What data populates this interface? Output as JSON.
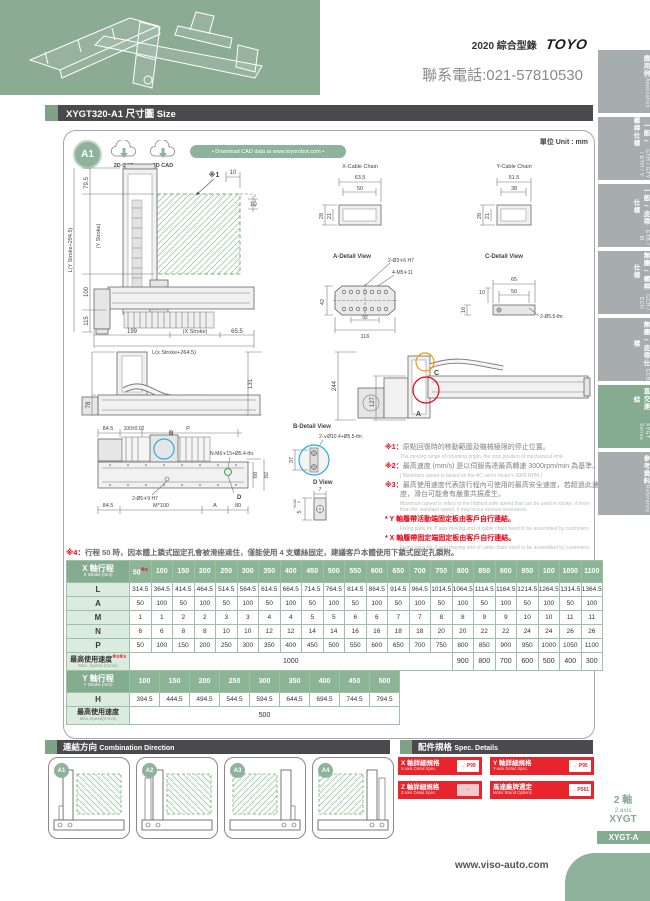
{
  "header": {
    "catalog": "2020 綜合型錄",
    "logo": "TOYO",
    "phone": "聯系電話:021-57810530"
  },
  "title_bar": {
    "text": "XYGT320-A1 尺寸圖 Size"
  },
  "panel": {
    "badge": "A1",
    "cad_2d": "2D CAD",
    "cad_3d": "3D CAD",
    "download": "• Download CAD data at www.toyorobot.com •",
    "unit": "單位 Unit : mm"
  },
  "drawing": {
    "front": {
      "d1": "79.5",
      "d2": "(Y Stroke)",
      "d3": "100",
      "d4": "115",
      "d5": "L(Y Stroke+294.5)",
      "ref": "※1",
      "d6": "10",
      "d7": "10",
      "d8": "199",
      "d9": "(X Stroke)",
      "d10": "65.5",
      "d11": "L(x Stroke+264.5)"
    },
    "xchain": {
      "title": "X-Cable Chain",
      "d1": "63.5",
      "d2": "50",
      "d3": "28",
      "d4": "21"
    },
    "ychain": {
      "title": "Y-Cable Chain",
      "d1": "51.5",
      "d2": "38",
      "d3": "28",
      "d4": "21"
    },
    "adetail": {
      "title": "A-Detail View",
      "c1": "2-Ø3∓6 H7",
      "c2": "4-M5∓11",
      "d1": "42",
      "d2": "52",
      "d3": "116"
    },
    "cdetail": {
      "title": "C-Detail View",
      "d1": "65",
      "d2": "10",
      "d3": "50",
      "d4": "16",
      "c1": "2-Ø5.5-thr."
    },
    "sideview": {
      "d1": "78",
      "d2": "131"
    },
    "ysideview": {
      "d1": "244",
      "d2": "127",
      "ca": "A",
      "cc": "C"
    },
    "plan": {
      "d1": "84.5",
      "d2": "100±0.02",
      "d3": "P",
      "b": "B",
      "c1": "N-M6∓15+Ø5.4-thr.",
      "d4": "68",
      "d5": "82",
      "c2": "2-Ø5∓9 H7",
      "dd": "D",
      "d6": "84.5",
      "d7": "M*100",
      "d8": "A",
      "d9": "80"
    },
    "bdetail": {
      "title": "B-Detail View",
      "c1": "2-∨Ø10.4+Ø5.5-thr.",
      "d1": "37"
    },
    "dview": {
      "title": "D View",
      "d1": "7",
      "d2": "5",
      "tp": "+0.012",
      "tz": "0"
    }
  },
  "notes": {
    "n1": {
      "mark": "※1：",
      "zh": "原點回復時的移動範圍及機械極限的停止位置。",
      "en": "The moving range of returning origin, the stop position of mechanical limit."
    },
    "n2": {
      "mark": "※2：",
      "zh": "最高速度 (mm/s) 是以伺服馬達最高轉速 3000rpm/min 為基準。",
      "en": "[ Maximum speed is based on the AC servo motor's 3000 RPM ]"
    },
    "n3": {
      "mark": "※3：",
      "zh": "最高使用速度代表該行程內可使用的最高安全速度，若超過此速度，滑台可能會有嚴重共振產生。",
      "en": "Maximum speed is refers to the highest safe speed that can be used in stroke, if more than the standard speed, it may occur serious resonance."
    },
    "ny": {
      "zh": "* Y 軸履帶活動端固定板由客戶自行連結。",
      "en": "Fixing plate for Y axis moving end of cable chain need to be assembled by customers."
    },
    "nx": {
      "zh": "* X 軸履帶固定端固定板由客戶自行連結。",
      "en": "Fixing plate for X axis moving end of cable chain need to be assembled by customers."
    },
    "n4": {
      "mark": "※4：",
      "zh": "行程 50 時，因本體上鎖式固定孔會被滑座遮住，僅能使用 4 支螺絲固定，建議客戶本體使用下鎖式固定孔鎖附。",
      "en": "When the stroke is 50mm, if fixing the body from the top to the bottom, the fixing hole will be blocked by slider and only can be uses 4 screws to fixas a result, suggest that fixing actuator body from the bottom to the top."
    }
  },
  "tables": {
    "x": {
      "label_zh": "X 軸行程",
      "label_en": "X Stroke (mm)",
      "stroke_note": "※4",
      "strokes": [
        "50",
        "100",
        "150",
        "200",
        "250",
        "300",
        "350",
        "400",
        "450",
        "500",
        "550",
        "600",
        "650",
        "700",
        "750",
        "800",
        "850",
        "900",
        "950",
        "100",
        "1050",
        "1100"
      ],
      "rows": [
        {
          "label": "L",
          "values": [
            "314.5",
            "364.5",
            "414.5",
            "464.5",
            "514.5",
            "564.5",
            "614.5",
            "664.5",
            "714.5",
            "764.5",
            "814.5",
            "864.5",
            "914.5",
            "964.5",
            "1014.5",
            "1064.5",
            "1114.5",
            "1164.5",
            "1214.5",
            "1264.5",
            "1314.5",
            "1364.5"
          ]
        },
        {
          "label": "A",
          "values": [
            "50",
            "100",
            "50",
            "100",
            "50",
            "100",
            "50",
            "100",
            "50",
            "100",
            "50",
            "100",
            "50",
            "100",
            "50",
            "100",
            "50",
            "100",
            "50",
            "100",
            "50",
            "100"
          ]
        },
        {
          "label": "M",
          "values": [
            "1",
            "1",
            "2",
            "2",
            "3",
            "3",
            "4",
            "4",
            "5",
            "5",
            "6",
            "6",
            "7",
            "7",
            "8",
            "8",
            "9",
            "9",
            "10",
            "10",
            "11",
            "11"
          ]
        },
        {
          "label": "N",
          "values": [
            "6",
            "6",
            "8",
            "8",
            "10",
            "10",
            "12",
            "12",
            "14",
            "14",
            "16",
            "16",
            "18",
            "18",
            "20",
            "20",
            "22",
            "22",
            "24",
            "24",
            "26",
            "26"
          ]
        },
        {
          "label": "P",
          "values": [
            "50",
            "100",
            "150",
            "200",
            "250",
            "300",
            "350",
            "400",
            "450",
            "500",
            "550",
            "600",
            "650",
            "700",
            "750",
            "800",
            "850",
            "900",
            "950",
            "1000",
            "1050",
            "1100"
          ]
        }
      ],
      "speed": {
        "zh": "最高使用速度",
        "marks": "※2※3",
        "en": "Max. Speed (mm/s)",
        "value": "1000",
        "span": 15,
        "rest": [
          "900",
          "800",
          "700",
          "600",
          "500",
          "400",
          "300"
        ]
      }
    },
    "y": {
      "label_zh": "Y 軸行程",
      "label_en": "Y Stroke (mm)",
      "stroke_note": "",
      "strokes": [
        "100",
        "150",
        "200",
        "250",
        "300",
        "350",
        "400",
        "450",
        "500"
      ],
      "rows": [
        {
          "label": "H",
          "values": [
            "394.5",
            "444.5",
            "494.5",
            "544.5",
            "594.5",
            "644.5",
            "694.5",
            "744.5",
            "794.5"
          ]
        }
      ],
      "speed": {
        "zh": "最高使用速度",
        "marks": "",
        "en": "Max.Speed(mm/s)",
        "value": "500",
        "span": 9,
        "rest": []
      }
    }
  },
  "combination": {
    "title_zh": "連結方向",
    "title_en": "Combination Direction",
    "items": [
      {
        "label": "A1"
      },
      {
        "label": "A2"
      },
      {
        "label": "A3"
      },
      {
        "label": "A4"
      }
    ]
  },
  "spec": {
    "title_zh": "配件規格",
    "title_en": "Spec. Details",
    "buttons": [
      {
        "zh": "X 軸詳細規格",
        "en": "X-axis Detail Spec.",
        "page": "→ P99",
        "active": true
      },
      {
        "zh": "Y 軸詳細規格",
        "en": "Y-axis Detail Spec.",
        "page": "→ P95",
        "active": true
      },
      {
        "zh": "Z 軸詳細規格",
        "en": "Z-axis Detail Spec.",
        "page": "-",
        "active": false
      },
      {
        "zh": "馬達廠牌選定",
        "en": "Motor Brand Options.",
        "page": "→ P561",
        "active": true
      }
    ]
  },
  "sidebar": {
    "tabs": [
      {
        "zh": "應用例",
        "en": "Application",
        "active": false
      },
      {
        "zh": "一般 / 螺桿仕樣",
        "en": "GTH / GTY / ETH / Y",
        "active": false
      },
      {
        "zh": "一般 / 皮帶仕樣",
        "en": "ETB / M",
        "active": false
      },
      {
        "zh": "無塵 / 螺桿仕樣",
        "en": "GCH / ECH",
        "active": false
      },
      {
        "zh": "無塵 / 皮帶仕樣",
        "en": "ECB",
        "active": false
      },
      {
        "zh": "直交連結",
        "en": "XYGT Series",
        "active": true
      },
      {
        "zh": "參考資料",
        "en": "Reference",
        "active": false
      }
    ]
  },
  "footer": {
    "axis_zh": "2 軸",
    "axis_en": "2 axis",
    "series": "XYGT",
    "tab": "XYGT-A",
    "url": "www.viso-auto.com"
  }
}
